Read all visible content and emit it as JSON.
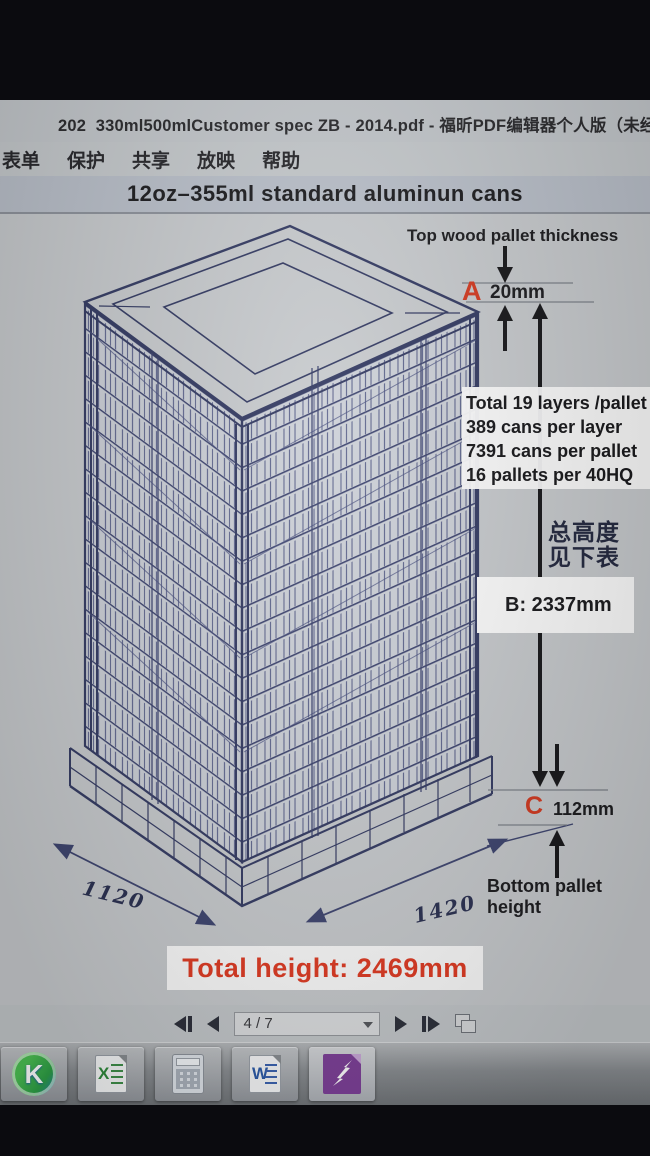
{
  "window": {
    "title": "202  330ml500mlCustomer spec ZB - 2014.pdf - 福昕PDF编辑器个人版（未经授权的",
    "menu": [
      "表单",
      "保护",
      "共享",
      "放映",
      "帮助"
    ]
  },
  "document": {
    "heading": "12oz–355ml standard aluminun cans",
    "labels": {
      "top_pallet": "Top wood pallet thickness",
      "dim_a_letter": "A",
      "dim_a_value": "20mm",
      "stats": [
        "Total 19 layers /pallet",
        "389 cans per layer",
        "7391 cans per pallet",
        "16 pallets per 40HQ"
      ],
      "height_note_1": "总高度",
      "height_note_2": "见下表",
      "dim_b": "B: 2337mm",
      "dim_c_letter": "C",
      "dim_c_value": "112mm",
      "bottom_pallet": "Bottom pallet height",
      "dim_width": "1120",
      "dim_depth": "1420",
      "total_height": "Total height: 2469mm"
    }
  },
  "nav": {
    "page_indicator": "4 / 7"
  },
  "taskbar": {
    "icon_glyphs": {
      "k": "K",
      "excel": "X",
      "word": "W"
    }
  },
  "colors": {
    "accent_red": "#d43a20",
    "line_blue": "#3e4570",
    "page_bg": "#c8cbce"
  }
}
